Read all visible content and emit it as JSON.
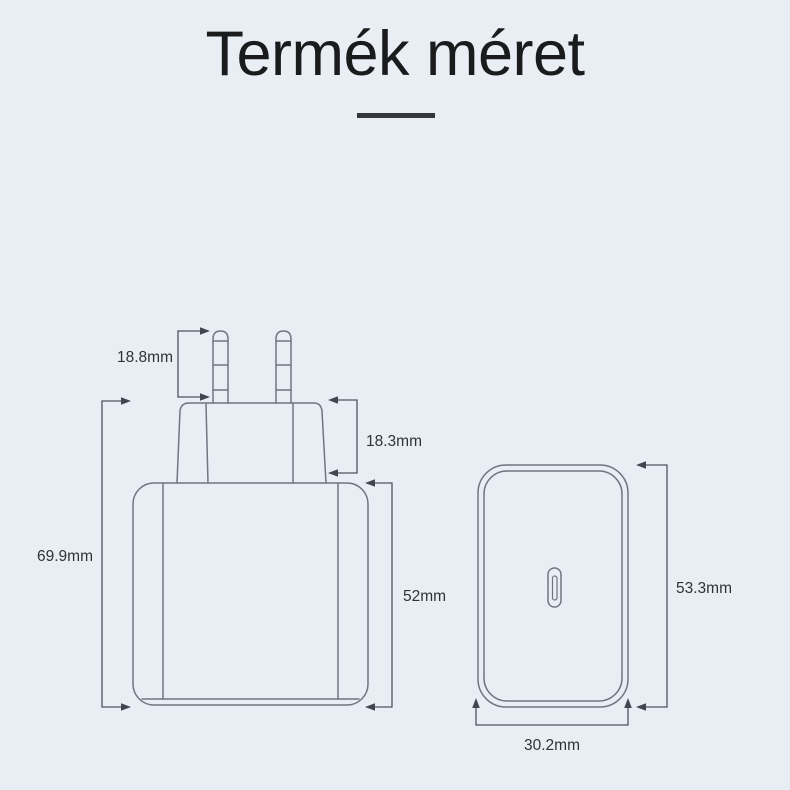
{
  "page": {
    "title": "Termék méret"
  },
  "diagram": {
    "product": "usb-c-wall-charger",
    "side_view": {
      "name": "charger-side-view-with-eu-plug",
      "dimensions": {
        "pin_height": "18.8mm",
        "plug_base_height": "18.3mm",
        "total_height": "69.9mm",
        "body_height": "52mm"
      }
    },
    "front_view": {
      "name": "charger-front-view-with-usb-c-port",
      "dimensions": {
        "height": "53.3mm",
        "width": "30.2mm"
      }
    }
  },
  "colors": {
    "background": "#e9eef5",
    "outline": "#6e7682",
    "dimension_line": "#4d545c",
    "arrow": "#40474f",
    "label_text": "#2e3338",
    "title_text": "#191b1d",
    "divider": "#35383b"
  }
}
